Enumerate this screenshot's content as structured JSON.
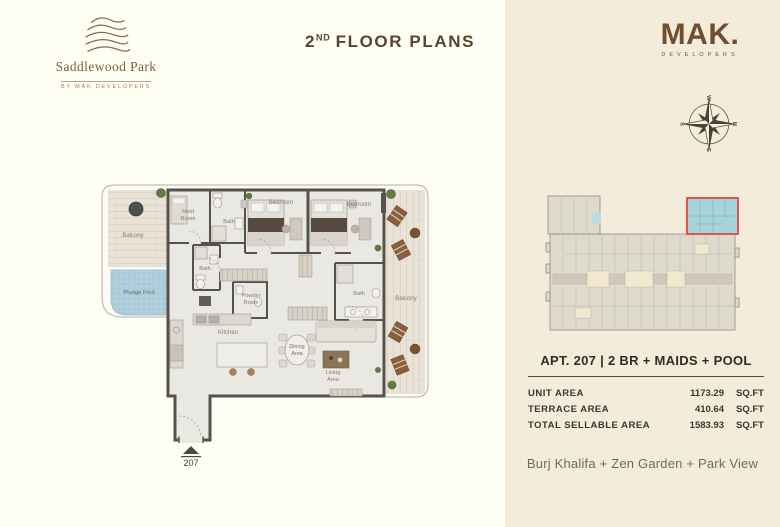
{
  "header": {
    "brand": {
      "name": "Saddlewood Park",
      "tagline": "BY MAK DEVELOPERS"
    },
    "title": {
      "number": "2",
      "ordinal": "ND",
      "rest": "FLOOR PLANS"
    },
    "developer": {
      "name": "MAK.",
      "tagline": "DEVELOPERS"
    }
  },
  "compass": {
    "n": "N",
    "e": "E",
    "s": "S",
    "w": "W"
  },
  "floor_plan": {
    "unit_number": "207",
    "labels": {
      "balcony_left": "Balcony",
      "plunge_pool": "Plunge Pool",
      "maid_line1": "Maid",
      "maid_line2": "Room",
      "bath_top": "Bath",
      "bedroom_1": "Bedroom",
      "bedroom_2": "Bedroom",
      "bath_mid": "Bath",
      "powder_line1": "Powder",
      "powder_line2": "Room",
      "kitchen": "Kitchen",
      "dining_line1": "Dining",
      "dining_line2": "Area",
      "living_line1": "Living",
      "living_line2": "Area",
      "bath_right": "Bath",
      "balcony_right": "Balcony"
    }
  },
  "unit_info": {
    "title": "APT. 207 | 2 BR + MAIDS + POOL",
    "rows": [
      {
        "label": "UNIT AREA",
        "value": "1173.29",
        "unit": "SQ.FT"
      },
      {
        "label": "TERRACE AREA",
        "value": "410.64",
        "unit": "SQ.FT"
      },
      {
        "label": "TOTAL SELLABLE AREA",
        "value": "1583.93",
        "unit": "SQ.FT"
      }
    ],
    "views": "Burj Khalifa + Zen Garden + Park View"
  },
  "colors": {
    "brand_brown": "#6f4e31",
    "title_brown": "#57452e",
    "accent_red": "#de4a3a",
    "highlight_teal": "#a7d4da",
    "pool_blue": "#aecdda",
    "left_panel_bg": "#fffef2",
    "right_panel_bg": "#f4ebda"
  }
}
